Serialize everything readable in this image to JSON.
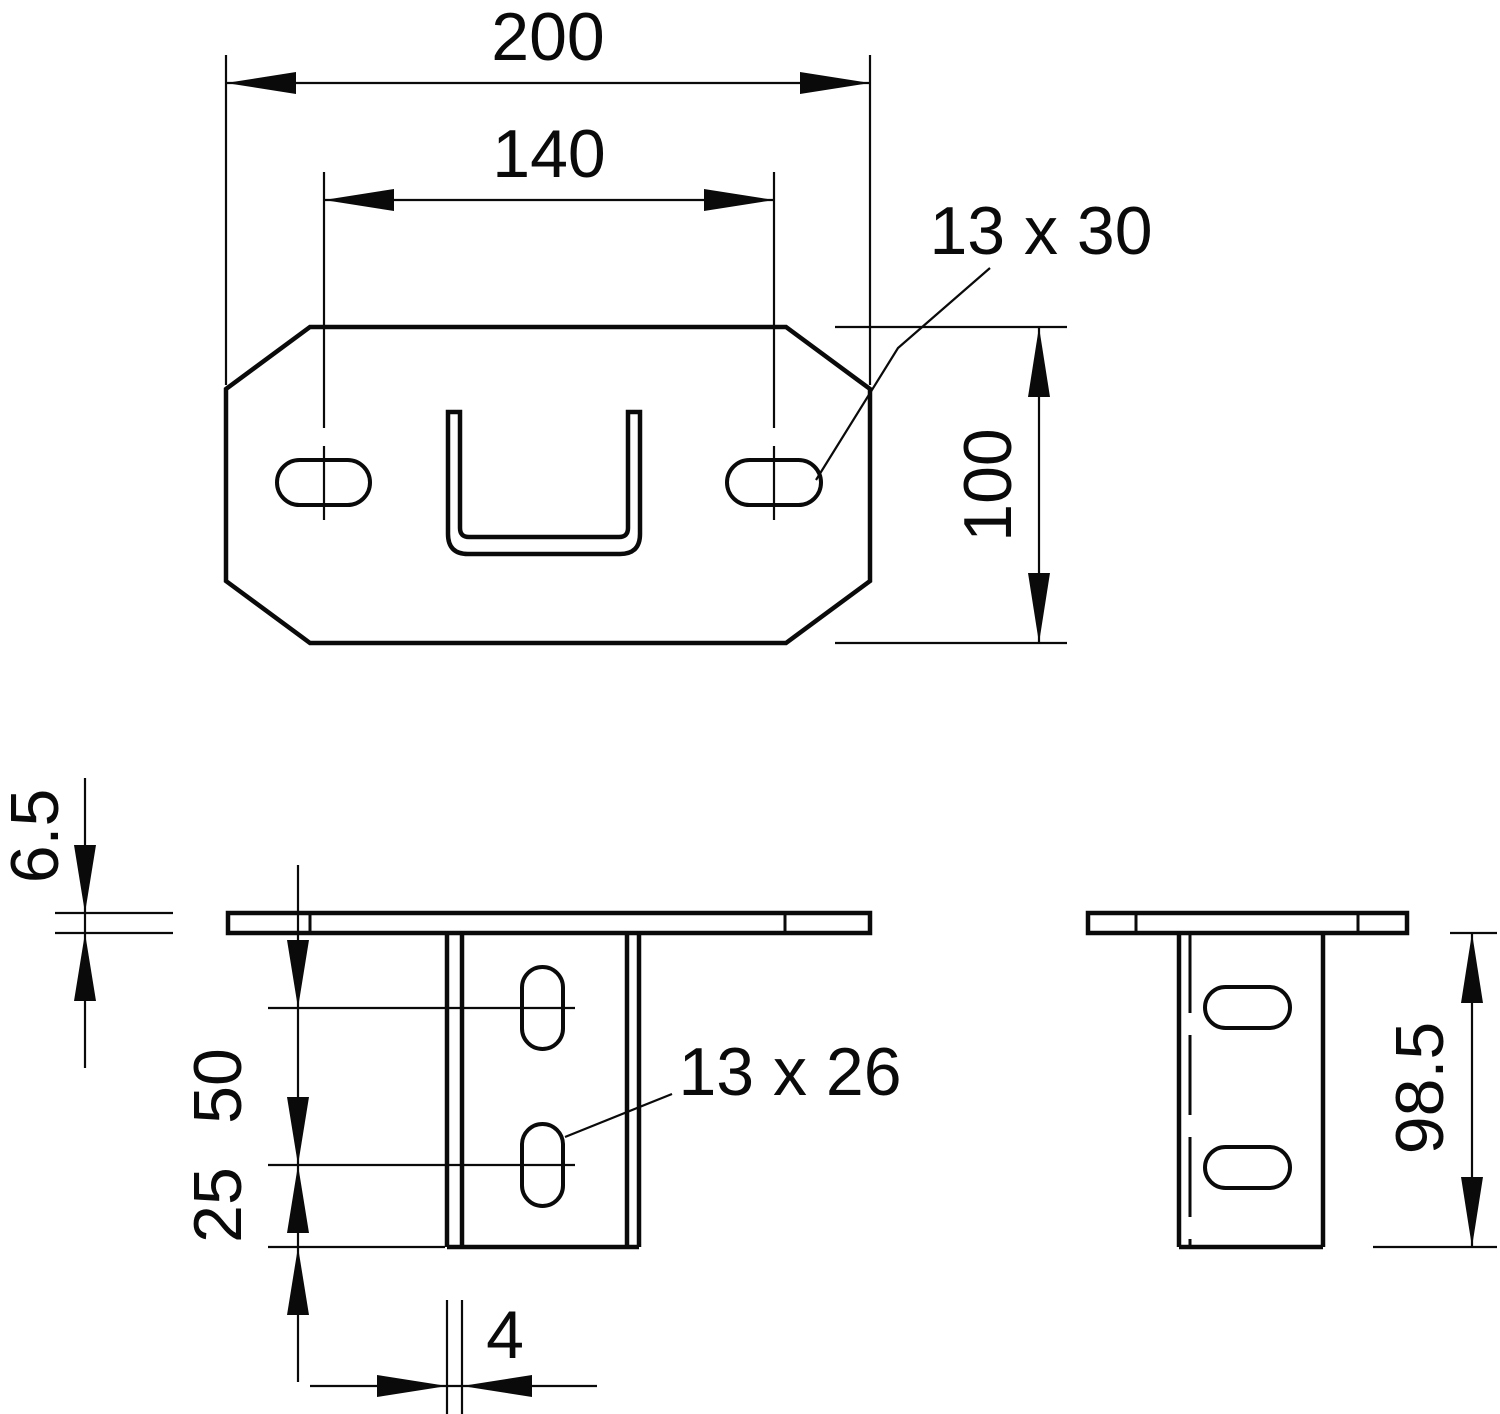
{
  "drawing": {
    "kind": "technical-dimension-drawing",
    "part": "mounting-plate-with-u-channel",
    "background": "#ffffff",
    "line_color": "#0a0a0a"
  },
  "labels": {
    "plate_width": "200",
    "hole_spacing": "140",
    "plate_slot_size": "13 x 30",
    "plate_depth": "100",
    "plate_thickness": "6.5",
    "web_slot_pitch": "50",
    "web_slot_edge_offset": "25",
    "web_slot_size": "13 x 26",
    "bracket_height": "98.5",
    "web_thickness": "4"
  }
}
